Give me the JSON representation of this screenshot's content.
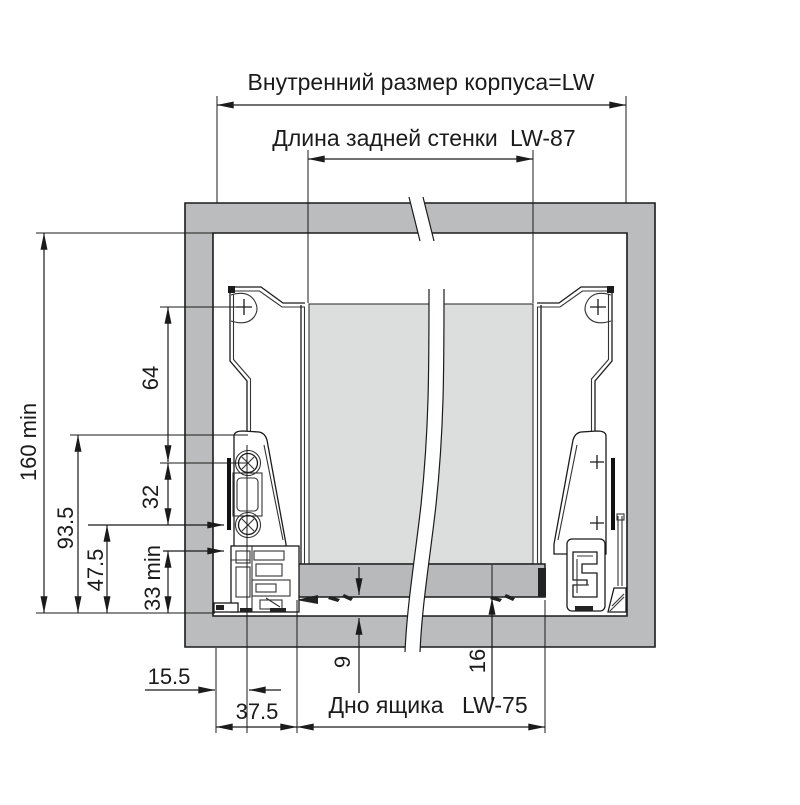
{
  "diagram": {
    "labels": {
      "top_dimension": "Внутренний размер корпуса=LW",
      "back_wall": "Длина задней стенки",
      "back_wall_value": "LW-87",
      "drawer_bottom": "Дно ящика",
      "drawer_bottom_value": "LW-75"
    },
    "dims": {
      "total_height_min": "160 min",
      "bracket_height": "93.5",
      "lower_height": "47.5",
      "upper_hole_spacing": "64",
      "lower_hole_spacing": "32",
      "bottom_clearance_min": "33 min",
      "front_offset": "15.5",
      "side_offset": "37.5",
      "bottom_gap": "9",
      "bottom_thickness": "16"
    },
    "colors": {
      "frame": "#babcbe",
      "back_panel": "#dcdddd",
      "drawer_bottom": "#b7b9bb",
      "line": "#1b1b1b",
      "accent_blue": "#3a5c86"
    }
  }
}
